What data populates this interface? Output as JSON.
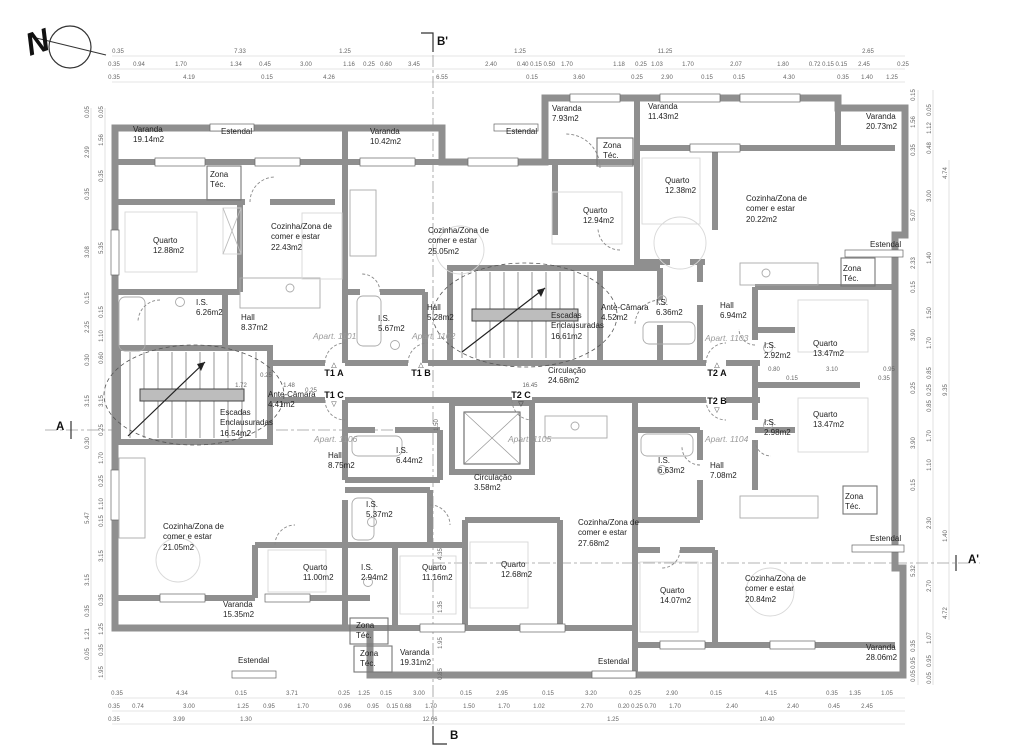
{
  "compass": {
    "label": "N"
  },
  "section_markers": [
    {
      "label": "B'",
      "x": 437,
      "y": 36
    },
    {
      "label": "B",
      "x": 450,
      "y": 730
    },
    {
      "label": "A",
      "x": 56,
      "y": 421
    },
    {
      "label": "A'",
      "x": 968,
      "y": 554
    }
  ],
  "unit_markers": [
    {
      "label": "T1 A",
      "x": 334,
      "y": 378,
      "tri": "up"
    },
    {
      "label": "T1 B",
      "x": 421,
      "y": 378,
      "tri": "up"
    },
    {
      "label": "T2 A",
      "x": 717,
      "y": 378,
      "tri": "up"
    },
    {
      "label": "T1 C",
      "x": 334,
      "y": 398,
      "tri": "down"
    },
    {
      "label": "T2 C",
      "x": 521,
      "y": 398,
      "tri": "down"
    },
    {
      "label": "T2 B",
      "x": 717,
      "y": 404,
      "tri": "down"
    }
  ],
  "apartments": [
    {
      "label": "Apart. 1101",
      "x": 313,
      "y": 331
    },
    {
      "label": "Apart. 1102",
      "x": 412,
      "y": 331
    },
    {
      "label": "Apart. 1103",
      "x": 705,
      "y": 333
    },
    {
      "label": "Apart. 1104",
      "x": 705,
      "y": 434
    },
    {
      "label": "Apart. 1105",
      "x": 508,
      "y": 434
    },
    {
      "label": "Apart. 1106",
      "x": 314,
      "y": 434
    }
  ],
  "rooms": [
    {
      "n": "Varanda",
      "a": "19.14m2",
      "x": 133,
      "y": 125
    },
    {
      "n": "Estendal",
      "a": "",
      "x": 221,
      "y": 127
    },
    {
      "n": "Varanda",
      "a": "10.42m2",
      "x": 370,
      "y": 127
    },
    {
      "n": "Estendal",
      "a": "",
      "x": 506,
      "y": 127
    },
    {
      "n": "Varanda",
      "a": "7.93m2",
      "x": 552,
      "y": 104
    },
    {
      "n": "Varanda",
      "a": "11.43m2",
      "x": 648,
      "y": 102
    },
    {
      "n": "Varanda",
      "a": "20.73m2",
      "x": 866,
      "y": 112
    },
    {
      "n": "Zona Téc.",
      "a": "",
      "x": 603,
      "y": 141,
      "w": 30
    },
    {
      "n": "Zona Téc.",
      "a": "",
      "x": 210,
      "y": 170,
      "w": 30
    },
    {
      "n": "Quarto",
      "a": "12.88m2",
      "x": 153,
      "y": 236
    },
    {
      "n": "Cozinha/Zona de comer e estar",
      "a": "22.43m2",
      "x": 271,
      "y": 222,
      "w": 66
    },
    {
      "n": "Cozinha/Zona de comer e estar",
      "a": "25.05m2",
      "x": 428,
      "y": 226,
      "w": 66
    },
    {
      "n": "Quarto",
      "a": "12.94m2",
      "x": 583,
      "y": 206
    },
    {
      "n": "Quarto",
      "a": "12.38m2",
      "x": 665,
      "y": 176
    },
    {
      "n": "Cozinha/Zona de comer e estar",
      "a": "20.22m2",
      "x": 746,
      "y": 194,
      "w": 66
    },
    {
      "n": "Estendal",
      "a": "",
      "x": 870,
      "y": 240
    },
    {
      "n": "Zona Téc.",
      "a": "",
      "x": 843,
      "y": 264,
      "w": 30
    },
    {
      "n": "I.S.",
      "a": "6.26m2",
      "x": 196,
      "y": 298
    },
    {
      "n": "Hall",
      "a": "8.37m2",
      "x": 241,
      "y": 313
    },
    {
      "n": "I.S.",
      "a": "5.67m2",
      "x": 378,
      "y": 314
    },
    {
      "n": "Hall",
      "a": "5.28m2",
      "x": 427,
      "y": 303
    },
    {
      "n": "Escadas Enclausuradas",
      "a": "16.61m2",
      "x": 551,
      "y": 311,
      "w": 56
    },
    {
      "n": "Ante-Câmara",
      "a": "4.52m2",
      "x": 601,
      "y": 303,
      "w": 58
    },
    {
      "n": "I.S.",
      "a": "6.36m2",
      "x": 656,
      "y": 298
    },
    {
      "n": "Hall",
      "a": "6.94m2",
      "x": 720,
      "y": 301
    },
    {
      "n": "I.S.",
      "a": "2.92m2",
      "x": 764,
      "y": 341
    },
    {
      "n": "Quarto",
      "a": "13.47m2",
      "x": 813,
      "y": 339
    },
    {
      "n": "Circulação",
      "a": "24.68m2",
      "x": 548,
      "y": 366
    },
    {
      "n": "Ante-Câmara",
      "a": "4.41m2",
      "x": 268,
      "y": 390,
      "w": 58
    },
    {
      "n": "Escadas Enclausuradas",
      "a": "16.54m2",
      "x": 220,
      "y": 408,
      "w": 56
    },
    {
      "n": "Hall",
      "a": "8.75m2",
      "x": 328,
      "y": 451
    },
    {
      "n": "I.S.",
      "a": "6.44m2",
      "x": 396,
      "y": 446
    },
    {
      "n": "Circulação",
      "a": "3.58m2",
      "x": 474,
      "y": 473
    },
    {
      "n": "I.S.",
      "a": "6.63m2",
      "x": 658,
      "y": 456
    },
    {
      "n": "Hall",
      "a": "7.08m2",
      "x": 710,
      "y": 461
    },
    {
      "n": "I.S.",
      "a": "2.98m2",
      "x": 764,
      "y": 418
    },
    {
      "n": "Quarto",
      "a": "13.47m2",
      "x": 813,
      "y": 410
    },
    {
      "n": "Zona Téc.",
      "a": "",
      "x": 845,
      "y": 492,
      "w": 30
    },
    {
      "n": "I.S.",
      "a": "5.37m2",
      "x": 366,
      "y": 500
    },
    {
      "n": "Cozinha/Zona de comer e estar",
      "a": "21.05m2",
      "x": 163,
      "y": 522,
      "w": 66
    },
    {
      "n": "Quarto",
      "a": "11.00m2",
      "x": 303,
      "y": 563
    },
    {
      "n": "I.S.",
      "a": "2.94m2",
      "x": 361,
      "y": 563
    },
    {
      "n": "Quarto",
      "a": "11.16m2",
      "x": 422,
      "y": 563
    },
    {
      "n": "Quarto",
      "a": "12.68m2",
      "x": 501,
      "y": 560
    },
    {
      "n": "Cozinha/Zona de comer e estar",
      "a": "27.68m2",
      "x": 578,
      "y": 518,
      "w": 66
    },
    {
      "n": "Quarto",
      "a": "14.07m2",
      "x": 660,
      "y": 586
    },
    {
      "n": "Cozinha/Zona de comer e estar",
      "a": "20.84m2",
      "x": 745,
      "y": 574,
      "w": 66
    },
    {
      "n": "Varanda",
      "a": "15.35m2",
      "x": 223,
      "y": 600
    },
    {
      "n": "Zona Téc.",
      "a": "",
      "x": 356,
      "y": 621,
      "w": 30
    },
    {
      "n": "Zona Téc.",
      "a": "",
      "x": 360,
      "y": 649,
      "w": 30
    },
    {
      "n": "Varanda",
      "a": "19.31m2",
      "x": 400,
      "y": 648
    },
    {
      "n": "Estendal",
      "a": "",
      "x": 238,
      "y": 656
    },
    {
      "n": "Estendal",
      "a": "",
      "x": 598,
      "y": 657
    },
    {
      "n": "Estendal",
      "a": "",
      "x": 870,
      "y": 534
    },
    {
      "n": "Varanda",
      "a": "28.06m2",
      "x": 866,
      "y": 643
    }
  ],
  "dims": {
    "h_rows": [
      {
        "y": 52,
        "items": [
          [
            "0.35",
            118
          ],
          [
            "7.33",
            240
          ],
          [
            "1.25",
            345
          ],
          [
            "1.25",
            520
          ],
          [
            "11.25",
            665
          ],
          [
            "2.65",
            868
          ]
        ]
      },
      {
        "y": 65,
        "items": [
          [
            "0.35",
            114
          ],
          [
            "0.94",
            139
          ],
          [
            "1.70",
            181
          ],
          [
            "1.34",
            236
          ],
          [
            "0.45",
            265
          ],
          [
            "3.00",
            306
          ],
          [
            "1.16",
            349
          ],
          [
            "0.25",
            369
          ],
          [
            "0.60",
            386
          ],
          [
            "3.45",
            414
          ],
          [
            "2.40",
            491
          ],
          [
            "0.40 0.15 0.50",
            536
          ],
          [
            "1.70",
            567
          ],
          [
            "1.18",
            619
          ],
          [
            "0.25",
            641
          ],
          [
            "1.03",
            657
          ],
          [
            "1.70",
            688
          ],
          [
            "2.07",
            736
          ],
          [
            "1.80",
            783
          ],
          [
            "0.72 0.15 0.15",
            828
          ],
          [
            "2.45",
            864
          ],
          [
            "0.25",
            903
          ]
        ]
      },
      {
        "y": 78,
        "items": [
          [
            "0.35",
            114
          ],
          [
            "4.19",
            189
          ],
          [
            "0.15",
            267
          ],
          [
            "4.26",
            329
          ],
          [
            "6.55",
            442
          ],
          [
            "0.15",
            532
          ],
          [
            "3.60",
            579
          ],
          [
            "0.25",
            637
          ],
          [
            "2.90",
            667
          ],
          [
            "0.15",
            707
          ],
          [
            "0.15",
            739
          ],
          [
            "4.30",
            789
          ],
          [
            "0.35",
            843
          ],
          [
            "1.40",
            867
          ],
          [
            "1.25",
            892
          ]
        ]
      },
      {
        "y": 694,
        "items": [
          [
            "0.35",
            117
          ],
          [
            "4.34",
            182
          ],
          [
            "0.15",
            241
          ],
          [
            "3.71",
            292
          ],
          [
            "0.25",
            344
          ],
          [
            "1.25",
            364
          ],
          [
            "0.15",
            386
          ],
          [
            "3.00",
            419
          ],
          [
            "0.15",
            466
          ],
          [
            "2.95",
            502
          ],
          [
            "0.15",
            548
          ],
          [
            "3.20",
            591
          ],
          [
            "0.25",
            635
          ],
          [
            "2.90",
            672
          ],
          [
            "0.15",
            716
          ],
          [
            "4.15",
            771
          ],
          [
            "0.35",
            832
          ],
          [
            "1.35",
            855
          ],
          [
            "1.05",
            887
          ]
        ]
      },
      {
        "y": 707,
        "items": [
          [
            "0.35",
            114
          ],
          [
            "0.74",
            138
          ],
          [
            "3.00",
            189
          ],
          [
            "1.25",
            243
          ],
          [
            "0.95",
            269
          ],
          [
            "1.70",
            303
          ],
          [
            "0.96",
            345
          ],
          [
            "0.95",
            373
          ],
          [
            "0.15 0.68",
            399
          ],
          [
            "1.70",
            431
          ],
          [
            "1.50",
            469
          ],
          [
            "1.70",
            504
          ],
          [
            "1.02",
            539
          ],
          [
            "2.70",
            587
          ],
          [
            "0.20 0.25 0.70",
            637
          ],
          [
            "1.70",
            675
          ],
          [
            "2.40",
            732
          ],
          [
            "2.40",
            793
          ],
          [
            "0.45",
            834
          ],
          [
            "2.45",
            867
          ]
        ]
      },
      {
        "y": 720,
        "items": [
          [
            "0.35",
            114
          ],
          [
            "3.99",
            179
          ],
          [
            "1.30",
            246
          ],
          [
            "12.66",
            430
          ],
          [
            "1.25",
            613
          ],
          [
            "10.40",
            767
          ]
        ]
      }
    ],
    "v_cols": [
      {
        "x": 88,
        "items": [
          [
            "0.05",
            112
          ],
          [
            "2.99",
            152
          ],
          [
            "0.35",
            194
          ],
          [
            "3.08",
            252
          ],
          [
            "0.15",
            298
          ],
          [
            "2.25",
            327
          ],
          [
            "0.30",
            360
          ],
          [
            "3.15",
            401
          ],
          [
            "0.30",
            443
          ],
          [
            "5.47",
            518
          ],
          [
            "3.15",
            580
          ],
          [
            "0.35",
            611
          ],
          [
            "1.21",
            634
          ],
          [
            "0.05",
            654
          ]
        ]
      },
      {
        "x": 102,
        "items": [
          [
            "0.05",
            112
          ],
          [
            "1.56",
            140
          ],
          [
            "0.35",
            176
          ],
          [
            "5.35",
            248
          ],
          [
            "0.15",
            312
          ],
          [
            "1.10",
            336
          ],
          [
            "0.60",
            358
          ],
          [
            "3.15",
            401
          ],
          [
            "0.25",
            430
          ],
          [
            "1.70",
            458
          ],
          [
            "0.25",
            481
          ],
          [
            "1.10",
            504
          ],
          [
            "0.15",
            521
          ],
          [
            "3.15",
            556
          ],
          [
            "0.35",
            600
          ],
          [
            "1.25",
            629
          ],
          [
            "0.35",
            650
          ],
          [
            "1.95",
            672
          ]
        ]
      },
      {
        "x": 914,
        "items": [
          [
            "0.15",
            95
          ],
          [
            "1.56",
            122
          ],
          [
            "0.35",
            150
          ],
          [
            "5.07",
            215
          ],
          [
            "2.33",
            263
          ],
          [
            "0.15",
            287
          ],
          [
            "3.90",
            335
          ],
          [
            "0.25",
            388
          ],
          [
            "3.90",
            443
          ],
          [
            "0.15",
            485
          ],
          [
            "5.32",
            571
          ],
          [
            "0.35",
            646
          ],
          [
            "0.95",
            663
          ],
          [
            "0.05",
            676
          ]
        ]
      },
      {
        "x": 930,
        "items": [
          [
            "0.05",
            110
          ],
          [
            "1.12",
            128
          ],
          [
            "0.48",
            148
          ],
          [
            "3.00",
            196
          ],
          [
            "1.40",
            258
          ],
          [
            "1.50",
            313
          ],
          [
            "1.70",
            343
          ],
          [
            "0.85",
            373
          ],
          [
            "0.25",
            390
          ],
          [
            "0.85",
            406
          ],
          [
            "1.70",
            436
          ],
          [
            "1.10",
            465
          ],
          [
            "2.30",
            523
          ],
          [
            "2.70",
            586
          ],
          [
            "1.07",
            638
          ],
          [
            "0.95",
            661
          ],
          [
            "0.05",
            678
          ]
        ]
      },
      {
        "x": 946,
        "items": [
          [
            "4.74",
            173
          ],
          [
            "9.35",
            390
          ],
          [
            "1.40",
            536
          ],
          [
            "4.72",
            613
          ]
        ]
      }
    ],
    "inner": [
      [
        "16.45",
        530,
        386,
        ""
      ],
      [
        "0.80",
        774,
        370,
        ""
      ],
      [
        "3.10",
        832,
        370,
        ""
      ],
      [
        "0.95",
        889,
        370,
        ""
      ],
      [
        "0.15",
        792,
        379,
        ""
      ],
      [
        "0.35",
        884,
        379,
        ""
      ],
      [
        "0.25",
        266,
        376,
        ""
      ],
      [
        "1.72",
        241,
        386,
        ""
      ],
      [
        "1.48",
        289,
        386,
        ""
      ],
      [
        "0.25",
        311,
        391,
        ""
      ],
      [
        "4.35",
        441,
        554,
        "v"
      ],
      [
        "1.35",
        441,
        607,
        "v"
      ],
      [
        "1.95",
        441,
        643,
        "v"
      ],
      [
        "0.85",
        441,
        674,
        "v"
      ],
      [
        "1.50",
        437,
        425,
        "v"
      ]
    ]
  },
  "colors": {
    "wall": "#8f8f8f",
    "thin_line": "#666666",
    "axis": "#9a9a9a",
    "text": "#222222",
    "apart_text": "#9a9a9a"
  }
}
